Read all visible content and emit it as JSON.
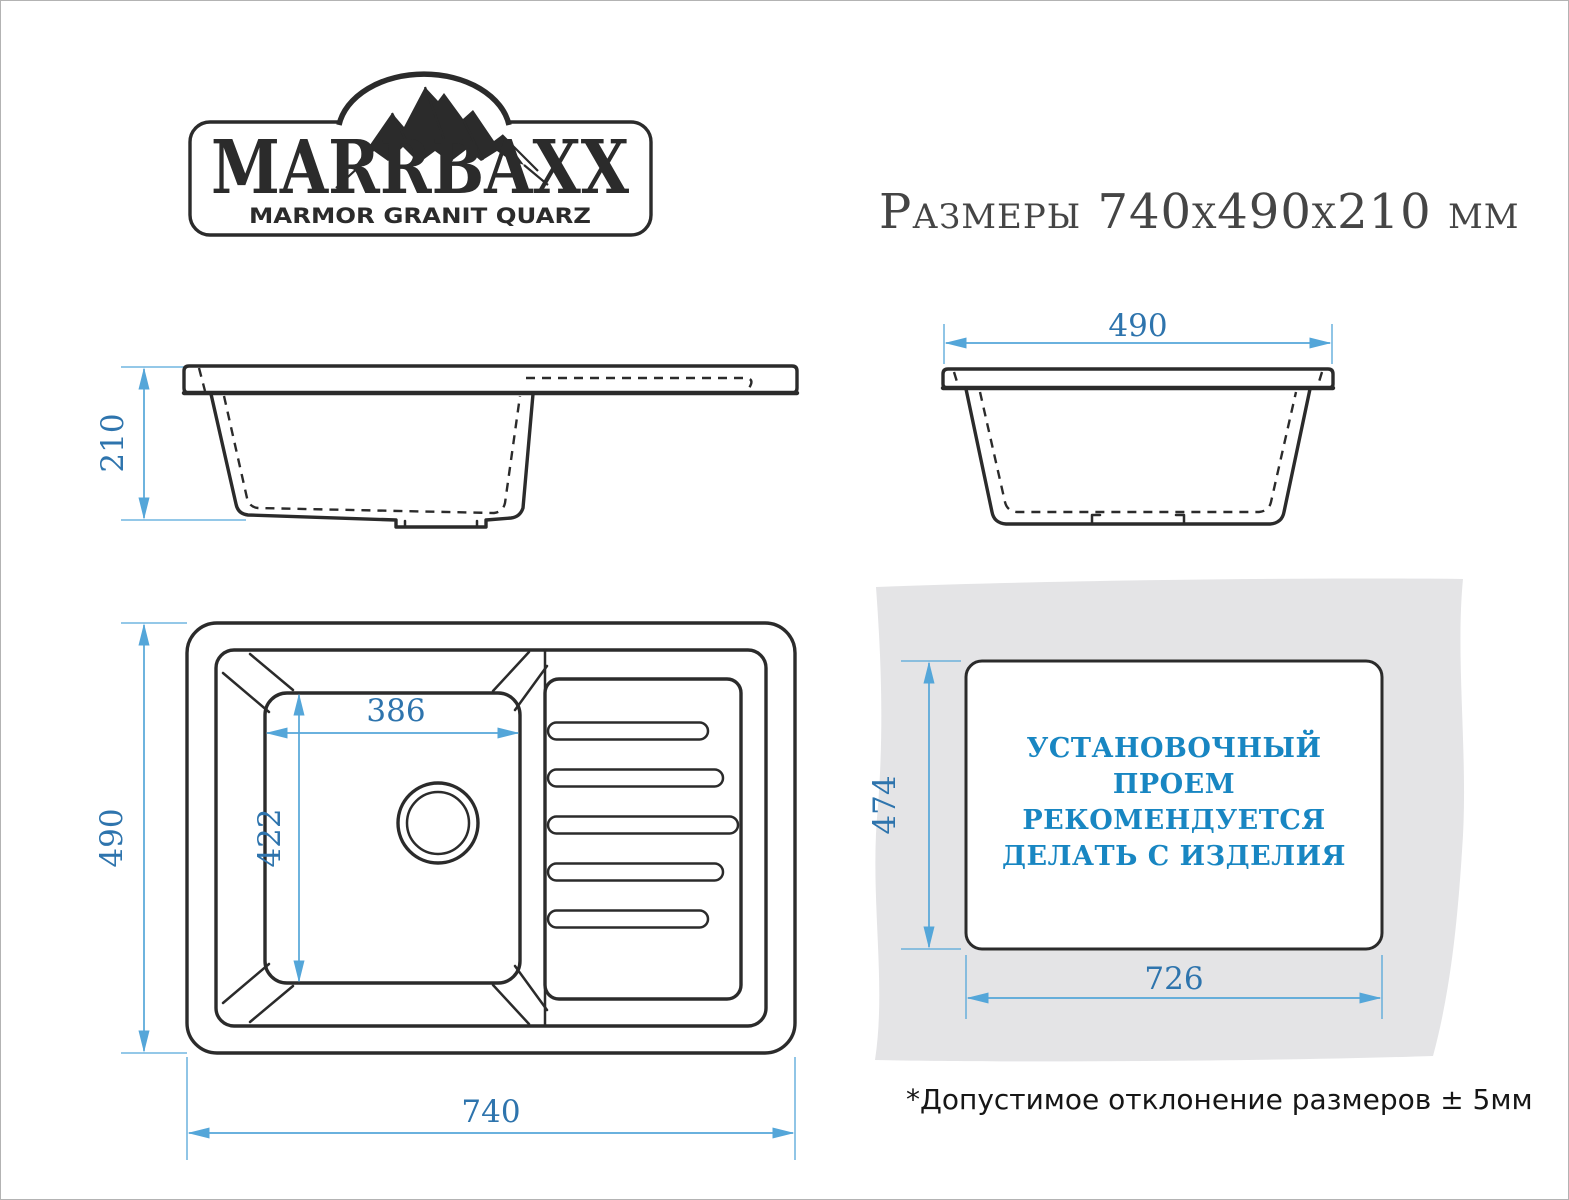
{
  "brand": {
    "name": "MARRBAXX",
    "tagline": "MARMOR GRANIT QUARZ"
  },
  "title": "Размеры 740х490х210 мм",
  "dimensions": {
    "height": "210",
    "width": "490",
    "length": "740",
    "top_depth": "490",
    "bowl_width": "386",
    "bowl_depth": "422",
    "cutout_height": "474",
    "cutout_width": "726"
  },
  "installation_note": {
    "line1": "УСТАНОВОЧНЫЙ",
    "line2": "ПРОЕМ",
    "line3": "РЕКОМЕНДУЕТСЯ",
    "line4": "ДЕЛАТЬ С ИЗДЕЛИЯ"
  },
  "footnote": "*Допустимое отклонение размеров  ± 5мм",
  "colors": {
    "line_art": "#2b2b2b",
    "dimension_line": "#54a6d9",
    "dimension_text": "#2e74ad",
    "install_text": "#1886c2",
    "counter_gray": "#e4e4e6"
  }
}
